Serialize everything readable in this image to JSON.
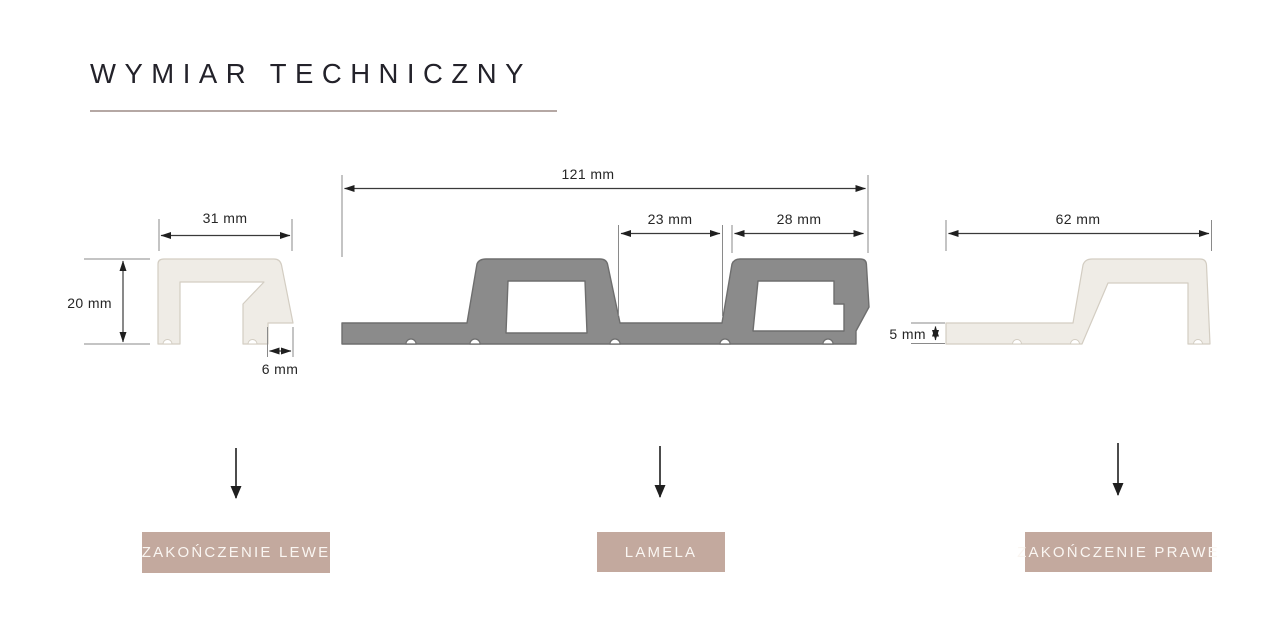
{
  "title": "WYMIAR TECHNICZNY",
  "colors": {
    "background": "#FFFFFF",
    "title_color": "#23222A",
    "underline": "#B5A8A4",
    "profile_light": "#EFECE6",
    "profile_light_stroke": "#D3CDC2",
    "profile_dark": "#8B8B8B",
    "profile_dark_stroke": "#6E6E6E",
    "accent_box": "#C3A99E",
    "box_text": "#FAF6F2",
    "dim_line": "#3A3A3A",
    "ext_line": "#8A8A8A",
    "arrow": "#1F1F1F"
  },
  "profiles": {
    "left": {
      "name": "ZAKOŃCZENIE LEWE",
      "dims": {
        "width": "31 mm",
        "height": "20 mm",
        "foot": "6 mm"
      }
    },
    "lamela": {
      "name": "LAMELA",
      "dims": {
        "width": "121 mm",
        "gap": "23 mm",
        "slat": "28 mm"
      }
    },
    "right": {
      "name": "ZAKOŃCZENIE PRAWE",
      "dims": {
        "width": "62 mm",
        "base": "5 mm"
      }
    }
  }
}
